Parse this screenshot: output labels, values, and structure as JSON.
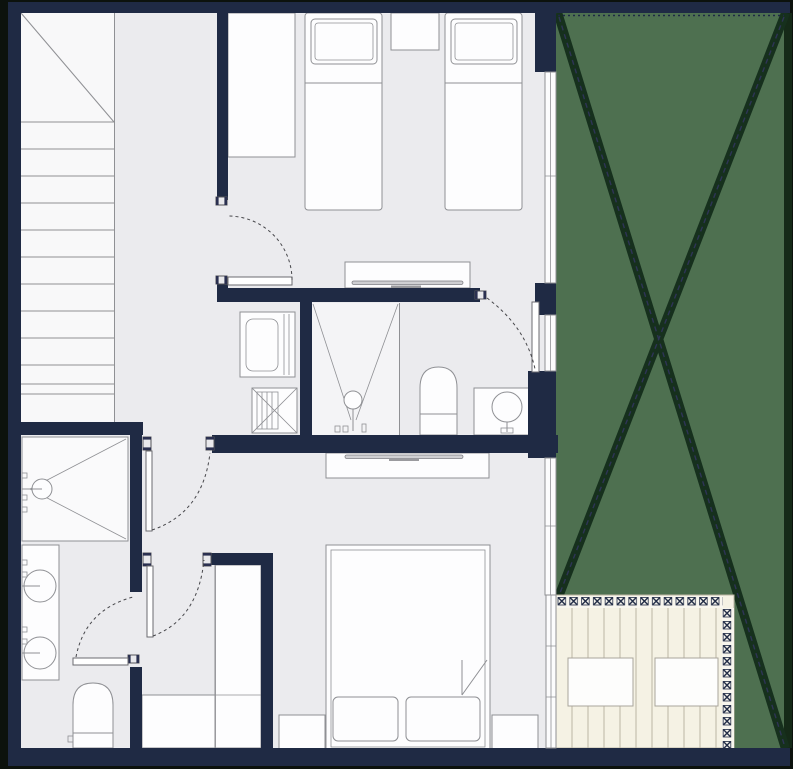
{
  "scene": {
    "description": "Residential upper-floor architectural floor plan with navy walls, light grey floors, a green cross-marked garden void on the right and a timber terrace deck at bottom right; no text labels are rendered in the drawing",
    "rooms": [
      "stairwell",
      "hallway",
      "twin-bedroom",
      "laundry-closet",
      "shower-room",
      "wc-bathroom",
      "master-bedroom",
      "walk-in-closet",
      "ensuite-bathroom",
      "terrace-deck",
      "garden-void"
    ]
  },
  "colors": {
    "outside": "#0c120d",
    "wall": "#1f2a44",
    "floor": "#ebebee",
    "stairs_bg": "#f8f8f9",
    "fixture_fill": "#fdfdfe",
    "fixture_line": "#8f9094",
    "arc": "#46464a",
    "green": "#4e7050",
    "green_x": "#16301d",
    "green_border": "#152a18",
    "green_dash": "#2e3456",
    "deck": "#f5f2e4",
    "deck_line": "#bcb6a4",
    "rail_bg": "#f8f6ee",
    "window_fill": "#fcfcfd"
  },
  "counts": {
    "stair_steps": 12,
    "single_beds": 2,
    "double_beds": 1,
    "round_basins": 3,
    "toilets": 2,
    "showers": 2,
    "washing_machines": 1,
    "deck_planks": 11,
    "doors_with_swing": 6,
    "windows_right_wall": 4
  }
}
